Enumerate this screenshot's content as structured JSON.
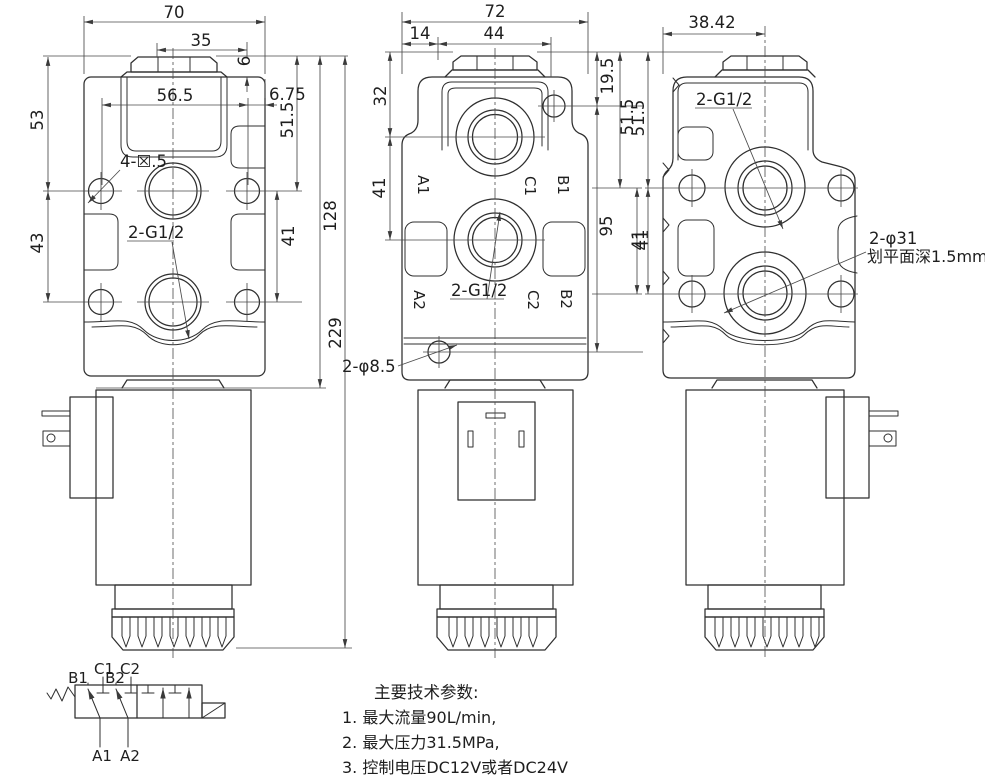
{
  "front": {
    "dim_width": "70",
    "dim_half_width": "35",
    "dim_nut_height": "6",
    "dim_hole_span": "56.5",
    "dim_edge_offset": "6.75",
    "dim_top_to_row1": "51.5",
    "dim_top_to_ports": "53",
    "dim_ports_span": "43",
    "dim_rows_span": "41",
    "dim_body_height": "128",
    "dim_total_height": "229",
    "label_mount_holes": "4-☒.5",
    "label_ports": "2-G1/2"
  },
  "port_face": {
    "dim_width": "72",
    "dim_step": "14",
    "dim_nut_span": "44",
    "dim_top_to_c1": "32",
    "dim_c1_c2": "41",
    "dim_pilot_hole": "19.5",
    "dim_top_to_ab": "51.5",
    "dim_holes_span": "95",
    "dim_ab_span": "41",
    "label_ports": "2-G1/2",
    "label_drain_holes": "2-φ8.5",
    "ports": {
      "a1": "A1",
      "c1": "C1",
      "b1": "B1",
      "a2": "A2",
      "c2": "C2",
      "b2": "B2"
    }
  },
  "side": {
    "dim_width": "38.42",
    "dim_top_to_row1": "51.5",
    "dim_rows_span": "41",
    "label_ports": "2-G1/2",
    "label_boss": "2-φ31",
    "label_boss_note": "划平面深1.5mm"
  },
  "schematic": {
    "b1": "B1",
    "c1": "C1",
    "b2": "B2",
    "c2": "C2",
    "a1": "A1",
    "a2": "A2"
  },
  "notes": {
    "title": "主要技术参数:",
    "item1": "1. 最大流量90L/min,",
    "item2": "2. 最大压力31.5MPa,",
    "item3": "3. 控制电压DC12V或者DC24V"
  }
}
